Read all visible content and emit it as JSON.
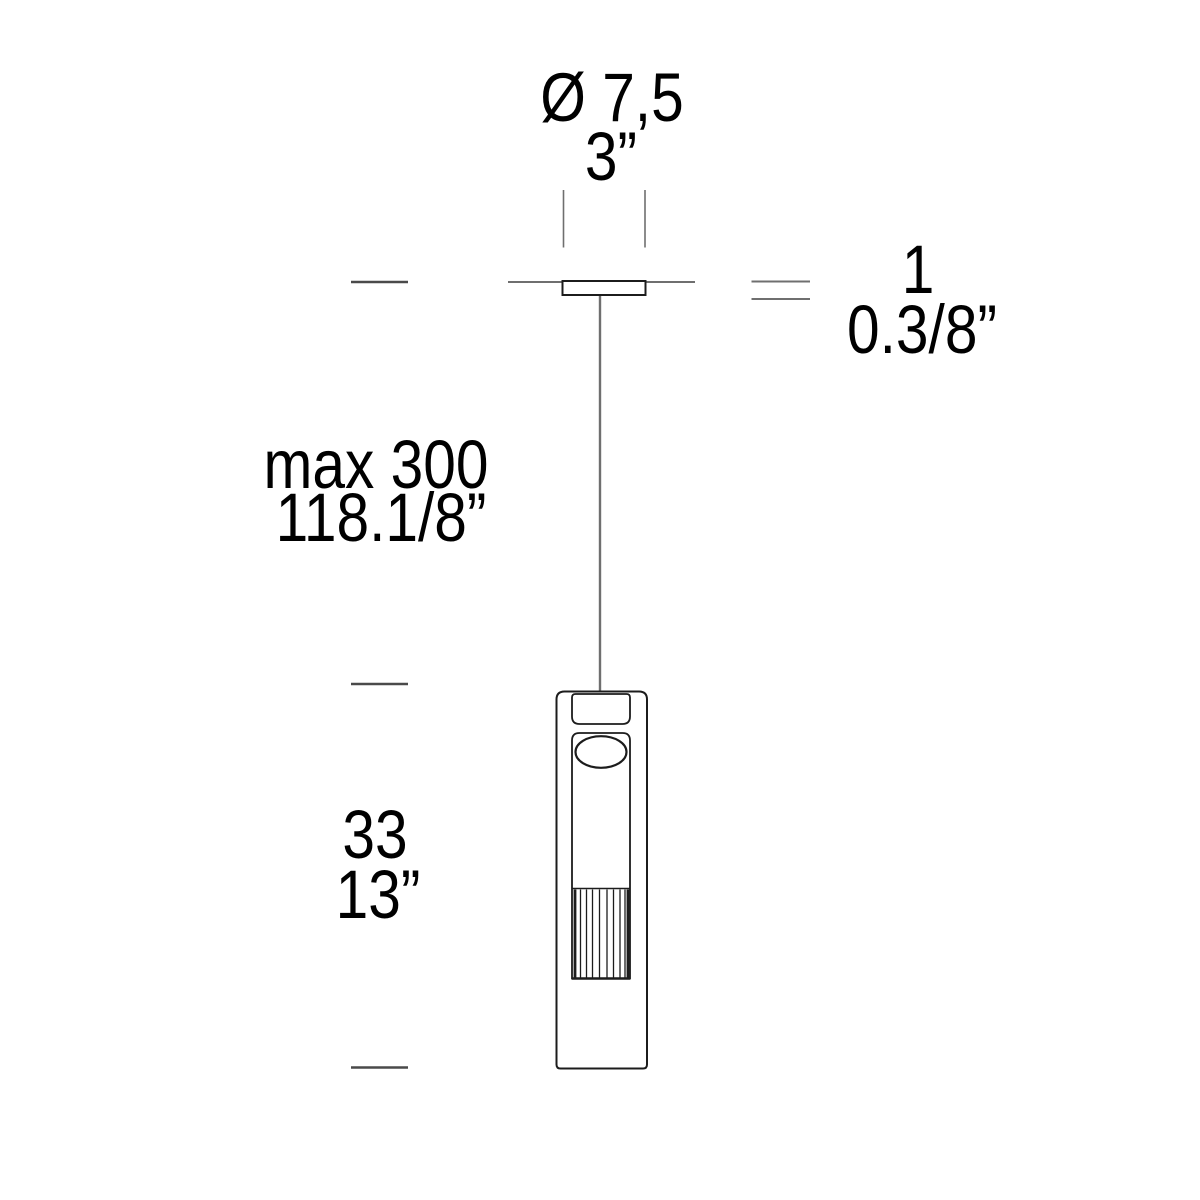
{
  "drawing": {
    "subject": "pendant-lamp-dimension-drawing"
  },
  "colors": {
    "background": "#ffffff",
    "ink": "#1c1c1c",
    "construction": "#6f6f6f",
    "tick": "#4a4a4a",
    "text": "#000000"
  },
  "labels": {
    "canopy_diameter": {
      "metric": "Ø 7,5",
      "imperial": "3”"
    },
    "canopy_thickness": {
      "metric": "1",
      "imperial": "0.3/8”"
    },
    "suspension_length": {
      "metric": "max 300",
      "imperial": "118.1/8”"
    },
    "body_height": {
      "metric": "33",
      "imperial": "13”"
    }
  }
}
